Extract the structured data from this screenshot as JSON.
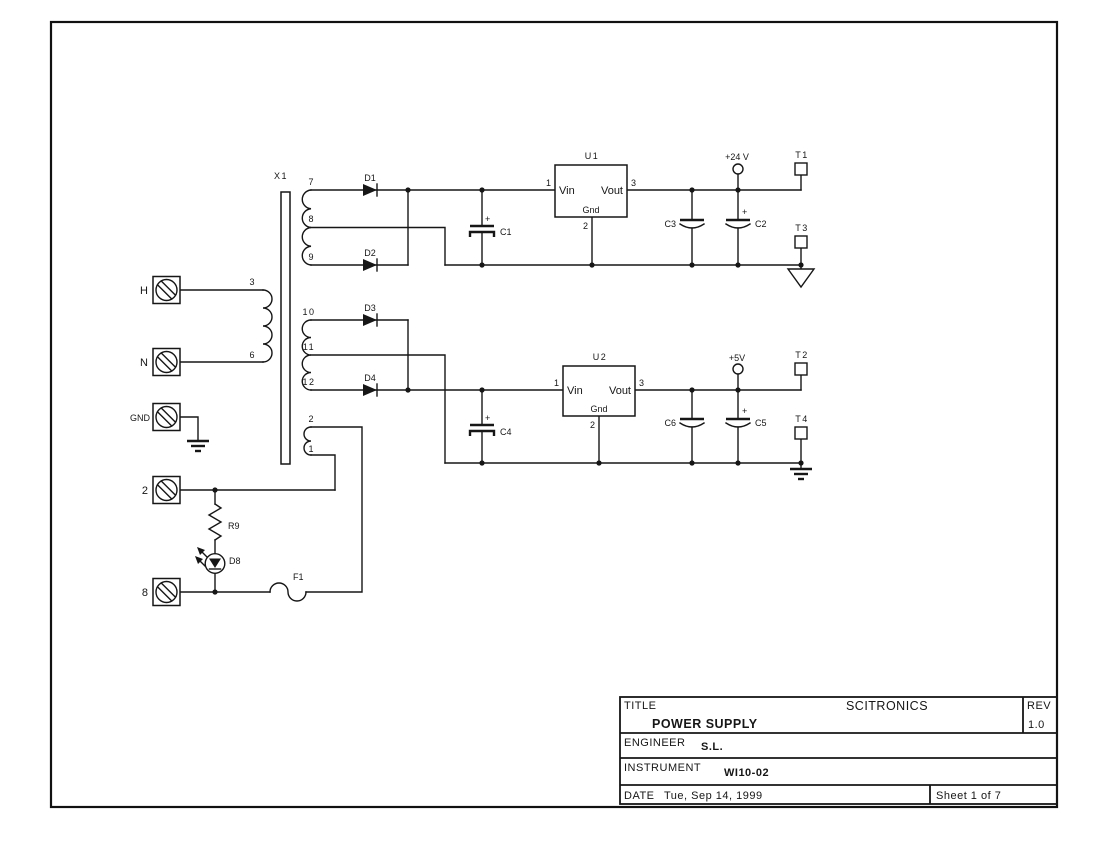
{
  "colors": {
    "line": "#161616",
    "background": "#ffffff"
  },
  "schematic": {
    "transformer": {
      "ref": "X1",
      "primary_top": "3",
      "primary_bottom": "6",
      "sec1_a": "7",
      "sec1_ct": "8",
      "sec1_b": "9",
      "sec2_a": "10",
      "sec2_ct": "11",
      "sec2_b": "12",
      "sec3_a": "2",
      "sec3_b": "1"
    },
    "terminals": {
      "h": "H",
      "n": "N",
      "gnd": "GND",
      "line2": "2",
      "line8": "8"
    },
    "diodes": {
      "d1": "D1",
      "d2": "D2",
      "d3": "D3",
      "d4": "D4"
    },
    "led": {
      "ref": "D8"
    },
    "resistor": {
      "ref": "R9"
    },
    "fuse": {
      "ref": "F1"
    },
    "caps": {
      "c1": "C1",
      "c2": "C2",
      "c3": "C3",
      "c4": "C4",
      "c5": "C5",
      "c6": "C6",
      "plus": "+"
    },
    "regulators": {
      "u1": {
        "ref": "U1",
        "vin": "Vin",
        "vout": "Vout",
        "gnd": "Gnd",
        "pin_in": "1",
        "pin_out": "3",
        "pin_gnd": "2"
      },
      "u2": {
        "ref": "U2",
        "vin": "Vin",
        "vout": "Vout",
        "gnd": "Gnd",
        "pin_in": "1",
        "pin_out": "3",
        "pin_gnd": "2"
      }
    },
    "power": {
      "rail24": "+24 V",
      "rail5": "+5V"
    },
    "testpoints": {
      "t1": "T1",
      "t2": "T2",
      "t3": "T3",
      "t4": "T4"
    }
  },
  "title_block": {
    "title_label": "TITLE",
    "company": "SCITRONICS",
    "rev_label": "REV",
    "rev_value": "1.0",
    "title_value": "POWER SUPPLY",
    "engineer_label": "ENGINEER",
    "engineer_value": "S.L.",
    "instrument_label": "INSTRUMENT",
    "instrument_value": "WI10-02",
    "date_label": "DATE",
    "date_value": "Tue, Sep 14, 1999",
    "sheet_info": "Sheet 1 of 7"
  }
}
